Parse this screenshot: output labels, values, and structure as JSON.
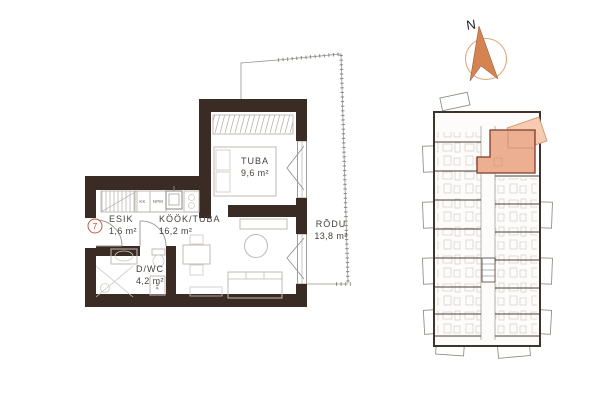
{
  "plan": {
    "unit_badge": "7",
    "rooms": [
      {
        "id": "esik",
        "name": "ESIK",
        "area": "1,6 m²"
      },
      {
        "id": "kook_tuba",
        "name": "KÖÖK/TUBA",
        "area": "16,2 m²"
      },
      {
        "id": "tuba",
        "name": "TUBA",
        "area": "9,6 m²"
      },
      {
        "id": "dwc",
        "name": "D/WC",
        "area": "4,2 m²"
      },
      {
        "id": "rodu",
        "name": "RÕDU",
        "area": "13,8 m²"
      }
    ],
    "appliance_labels": {
      "fridge": "KK",
      "dishwasher": "NPM",
      "washing_machine": "PM"
    }
  },
  "compass": {
    "north_label": "N"
  },
  "colors": {
    "background": "#ffffff",
    "walls": "#3a2b25",
    "furniture_lines": "#c0b9b2",
    "label_text": "#45403c",
    "unit_badge_red": "#c0442e",
    "overview_highlight_fill": "#edaf92",
    "overview_highlight_wall": "#7d3a29",
    "overview_balcony_fill": "#f6cbb0",
    "compass_arrow": "#d58350",
    "compass_ring": "#e0a87f"
  }
}
